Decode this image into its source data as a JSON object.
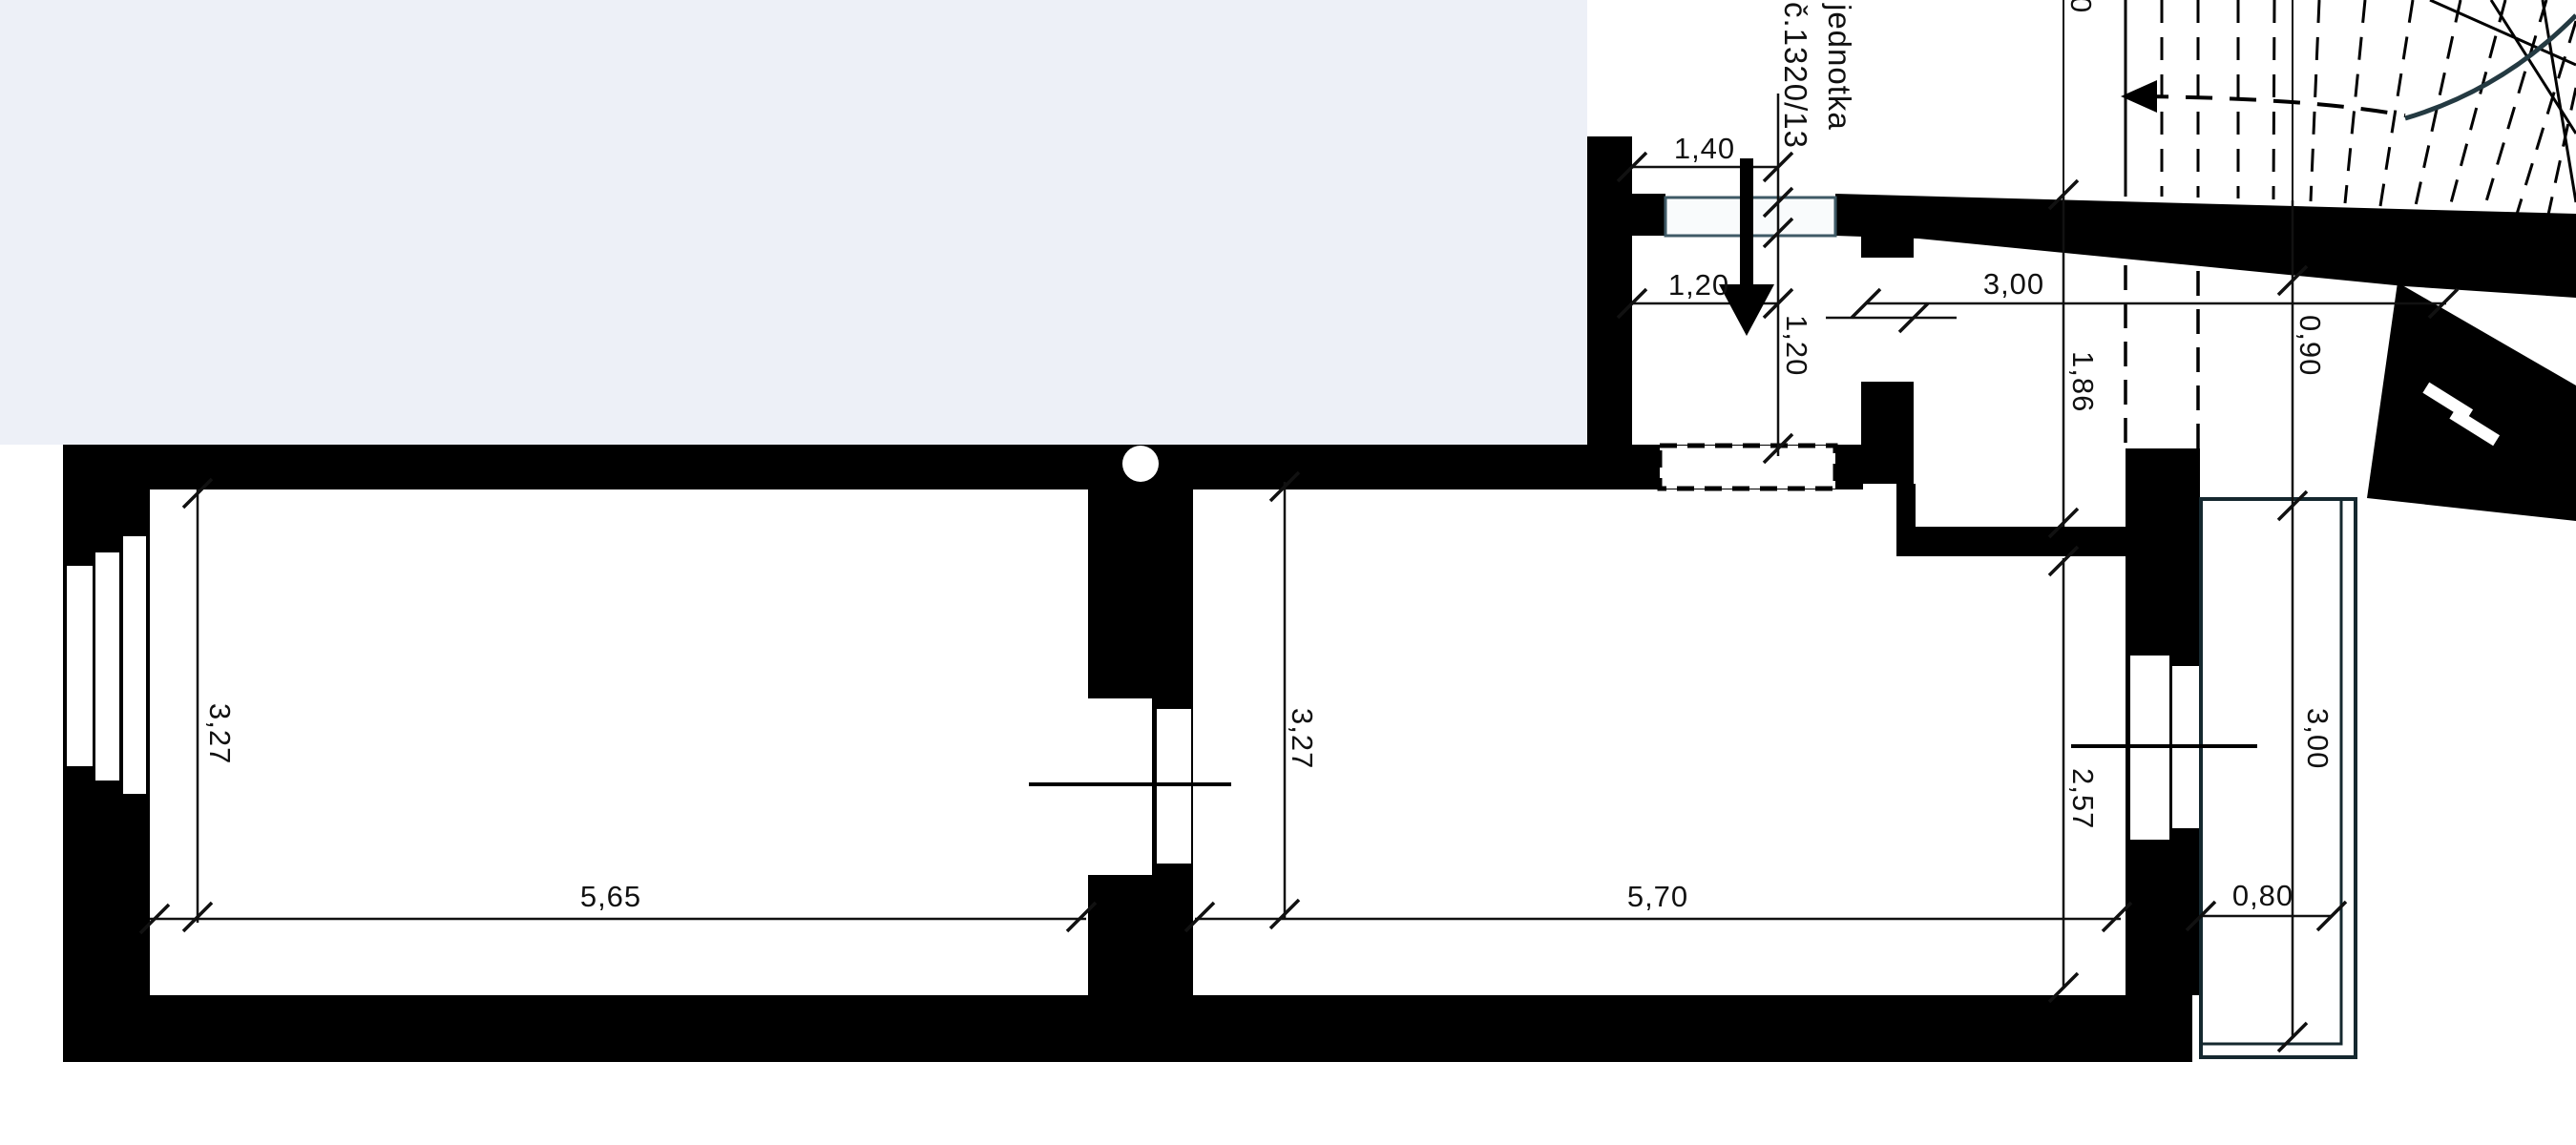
{
  "plan": {
    "title": "floor plan of unit",
    "unit": {
      "line1": "jednotka",
      "line2": "č.1320/13"
    },
    "dimensions": {
      "entry_opening_width": "1,40",
      "entry_clear_width": "1,20",
      "entry_depth": "1,20",
      "hall_length": "3,00",
      "hall_width": "1,86",
      "landing_width": "0,90",
      "room_right_depth_right": "2,57",
      "balcony_length": "3,00",
      "balcony_width": "0,80",
      "room_left_length": "5,65",
      "room_left_depth": "3,27",
      "room_right_depth_left": "3,27",
      "room_right_length": "5,70",
      "partial_top_label": "0"
    },
    "colors": {
      "background": "#ffffff",
      "exterior_field": "#edf0f7",
      "wall": "#000000",
      "balcony_accent": "#15282f",
      "door_accent": "#3f5a66",
      "stair_arc": "#243a42"
    }
  }
}
